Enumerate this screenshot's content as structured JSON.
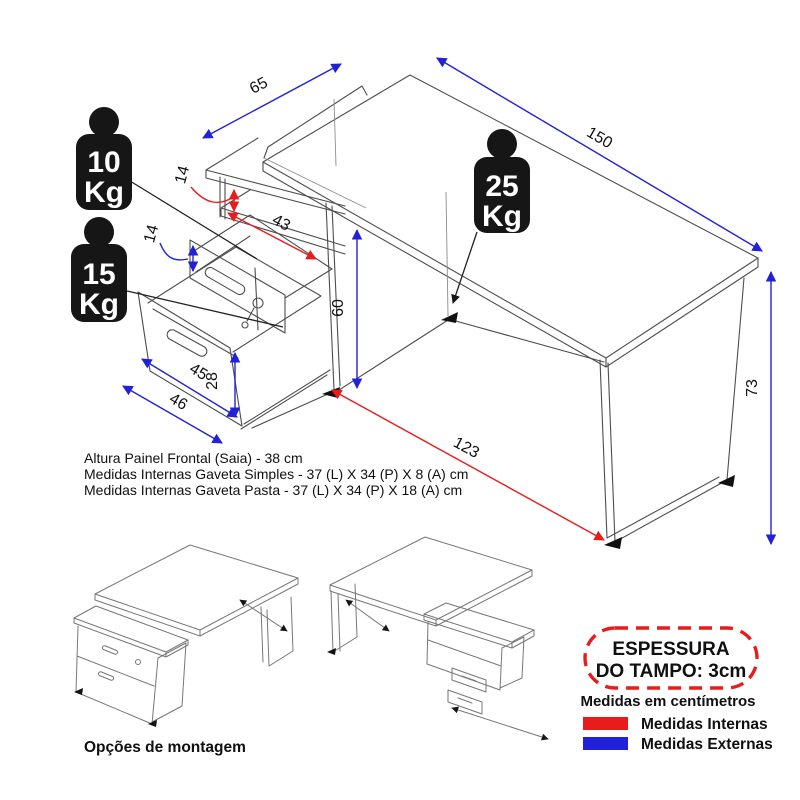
{
  "diagram": {
    "weights": {
      "drawer_simple": {
        "value": "10",
        "unit": "Kg"
      },
      "drawer_file": {
        "value": "15",
        "unit": "Kg"
      },
      "desktop": {
        "value": "25",
        "unit": "Kg"
      }
    },
    "dimensions": {
      "top_depth": {
        "value": "65",
        "measure": "external"
      },
      "top_length": {
        "value": "150",
        "measure": "external"
      },
      "niche_height": {
        "value": "14",
        "measure": "internal"
      },
      "niche_depth": {
        "value": "43",
        "measure": "internal"
      },
      "drawer_front_height": {
        "value": "14",
        "measure": "external"
      },
      "pedestal_height": {
        "value": "60",
        "measure": "external"
      },
      "desk_height": {
        "value": "73",
        "measure": "external"
      },
      "drawer_front_width": {
        "value": "45",
        "measure": "external"
      },
      "file_drawer_front_height": {
        "value": "28",
        "measure": "external"
      },
      "pedestal_width": {
        "value": "46",
        "measure": "external"
      },
      "knee_clearance": {
        "value": "123",
        "measure": "internal"
      }
    },
    "notes": {
      "line1": "Altura Painel Frontal (Saia) - 38 cm",
      "line2": "Medidas Internas Gaveta Simples -  37 (L) X 34 (P) X 8 (A) cm",
      "line3": "Medidas Internas Gaveta Pasta -  37 (L) X 34 (P) X 18 (A) cm"
    },
    "options_label": "Opções de montagem",
    "legend": {
      "top_thickness_line1": "ESPESSURA",
      "top_thickness_line2": "DO TAMPO: 3cm",
      "units_note": "Medidas em centímetros",
      "internal_label": "Medidas Internas",
      "external_label": "Medidas Externas"
    },
    "colors": {
      "internal": "#e81c1c",
      "external": "#2121d8"
    }
  }
}
